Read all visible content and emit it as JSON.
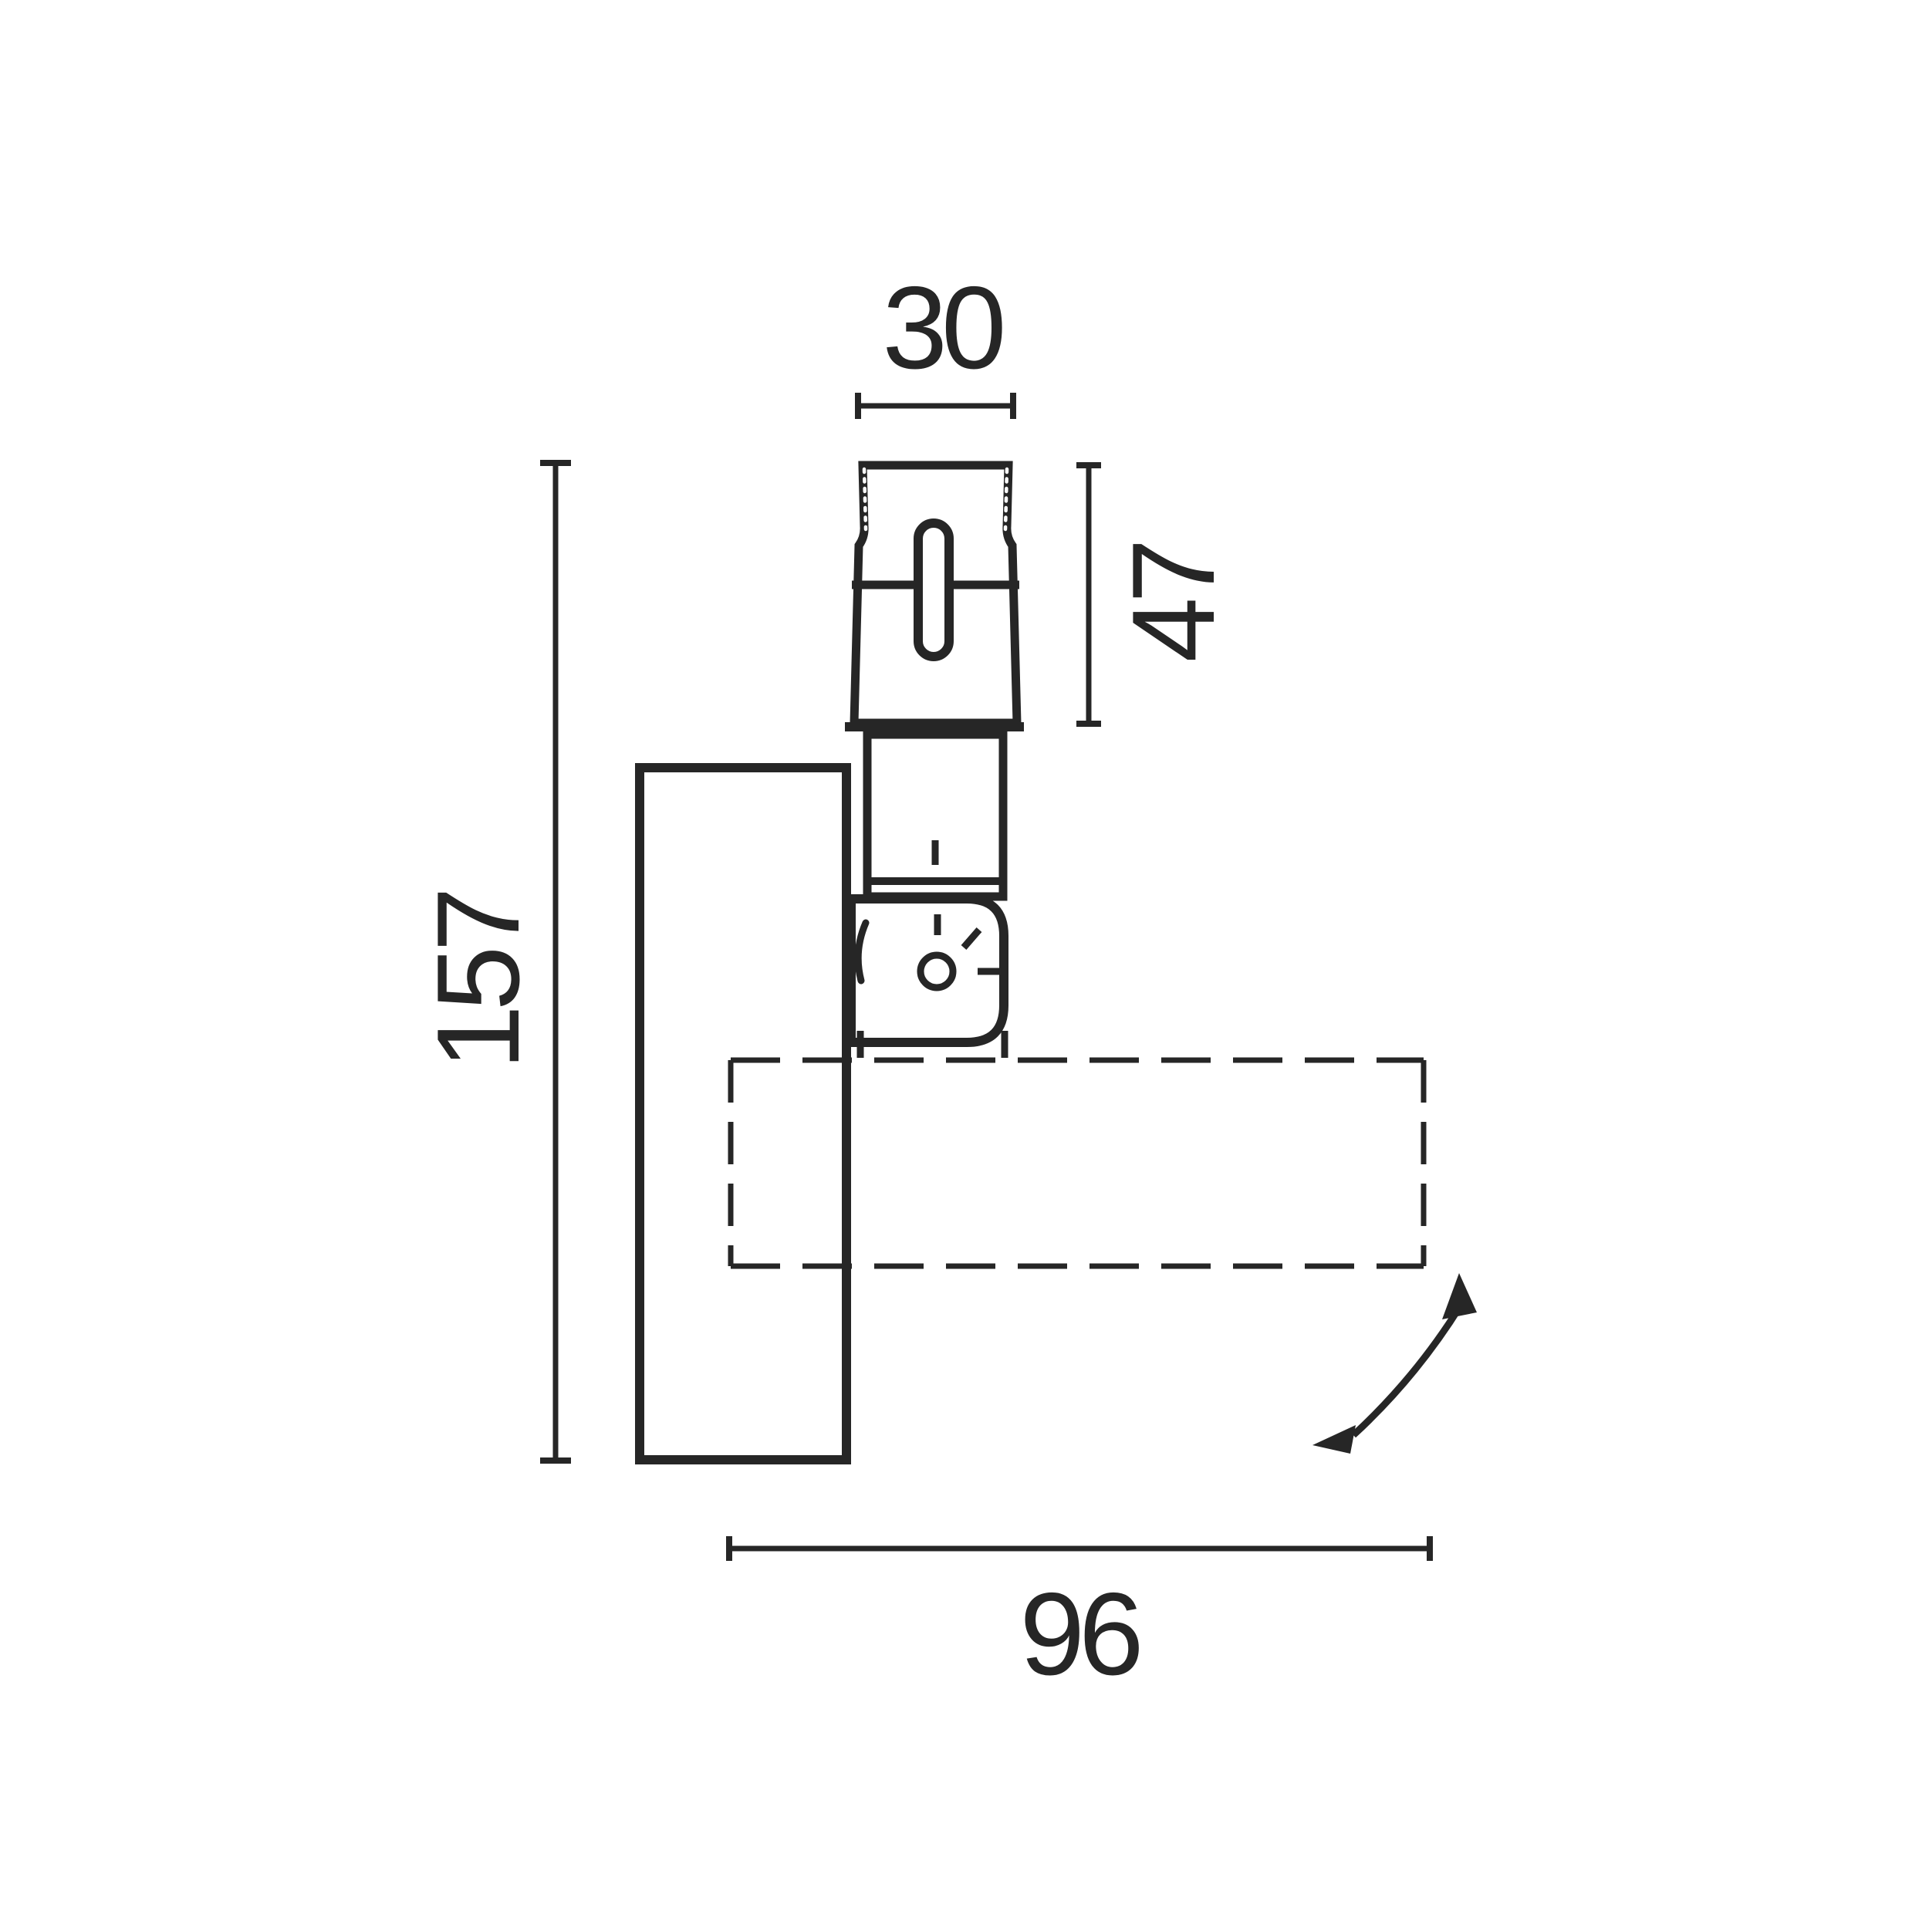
{
  "drawing": {
    "type": "technical-dimension-drawing",
    "subject": "window-handle-side-view",
    "colors": {
      "line": "#262626",
      "background": "#ffffff"
    },
    "dimensions": {
      "knob_width": "30",
      "knob_height": "47",
      "total_height": "157",
      "handle_length": "96"
    },
    "icons": [
      "rotation-arrow"
    ]
  }
}
